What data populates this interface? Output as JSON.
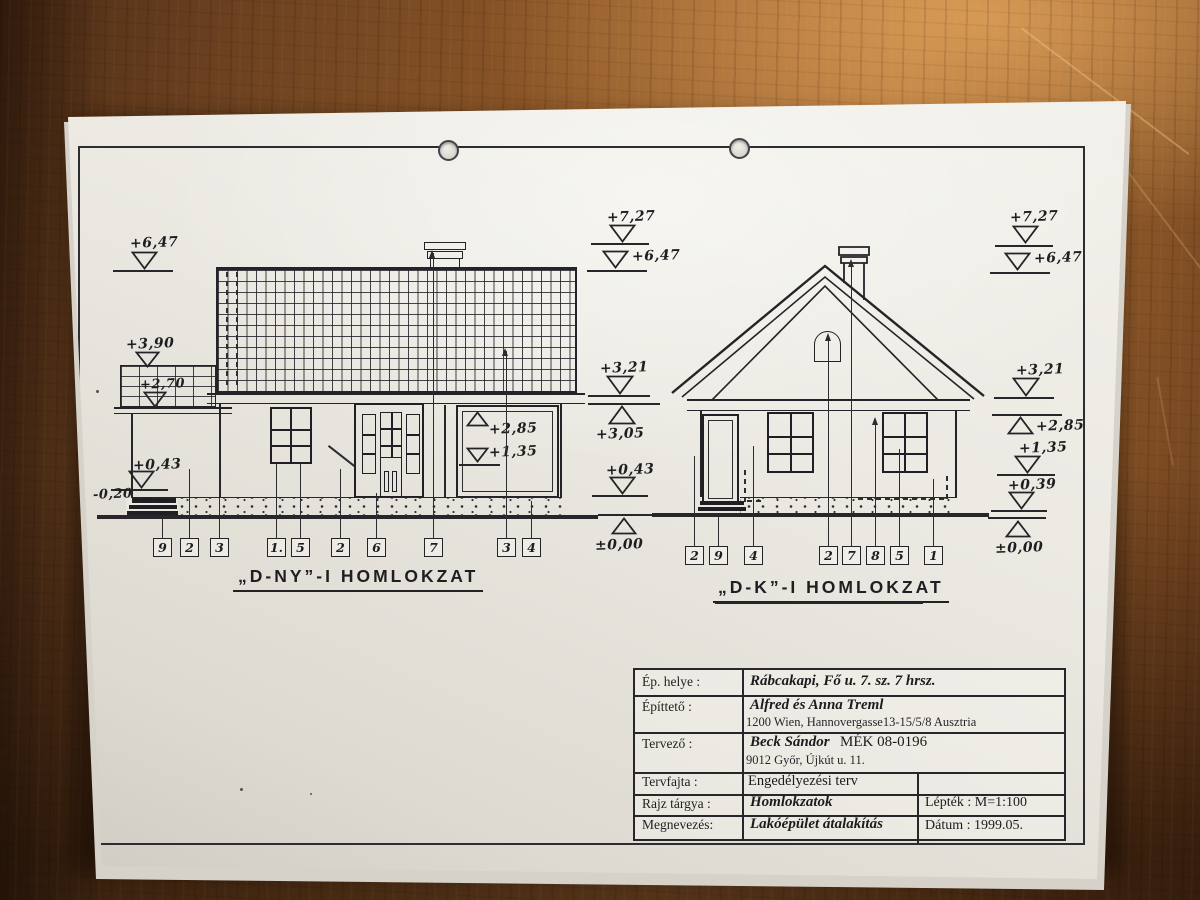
{
  "sheet": {
    "margin_note": "8"
  },
  "elevations": {
    "left": {
      "title": "„D-NY”-I  HOMLOKZAT",
      "tags": [
        "9",
        "2",
        "3",
        "1.",
        "5",
        "2",
        "6",
        "7",
        "3",
        "4"
      ],
      "inner_levels": [
        "+2,85",
        "+1,35"
      ]
    },
    "right": {
      "title": "„D-K”-I  HOMLOKZAT",
      "tags": [
        "2",
        "9",
        "4",
        "2",
        "7",
        "8",
        "5",
        "1"
      ]
    }
  },
  "levels": {
    "left": [
      "+6,47",
      "+3,90",
      "+2,70",
      "+0,43",
      "-0,20"
    ],
    "middle": [
      "+7,27",
      "+6,47",
      "+3,21",
      "+3,05",
      "+0,43",
      "±0,00"
    ],
    "right": [
      "+7,27",
      "+6,47",
      "+3,21",
      "+2,85",
      "+1,35",
      "+0,39",
      "±0,00"
    ]
  },
  "title_block": {
    "rows": [
      {
        "label": "Ép. helye :",
        "value": "Rábcakapi, Fő u. 7. sz. 7 hrsz."
      },
      {
        "label": "Építtető :",
        "value": "Alfred és Anna  Treml",
        "line2": "1200 Wien, Hannovergasse13-15/5/8  Ausztria"
      },
      {
        "label": "Tervező :",
        "value": "Beck Sándor",
        "reg": "MÉK 08-0196",
        "line2": "9012 Győr, Újkút u. 11."
      },
      {
        "label": "Tervfajta :",
        "plain": "Engedélyezési terv"
      },
      {
        "label": "Rajz tárgya :",
        "value": "Homlokzatok",
        "right": "Lépték : M=1:100"
      },
      {
        "label": "Megnevezés:",
        "value": "Lakóépület átalakítás",
        "right": "Dátum : 1999.05."
      }
    ]
  }
}
